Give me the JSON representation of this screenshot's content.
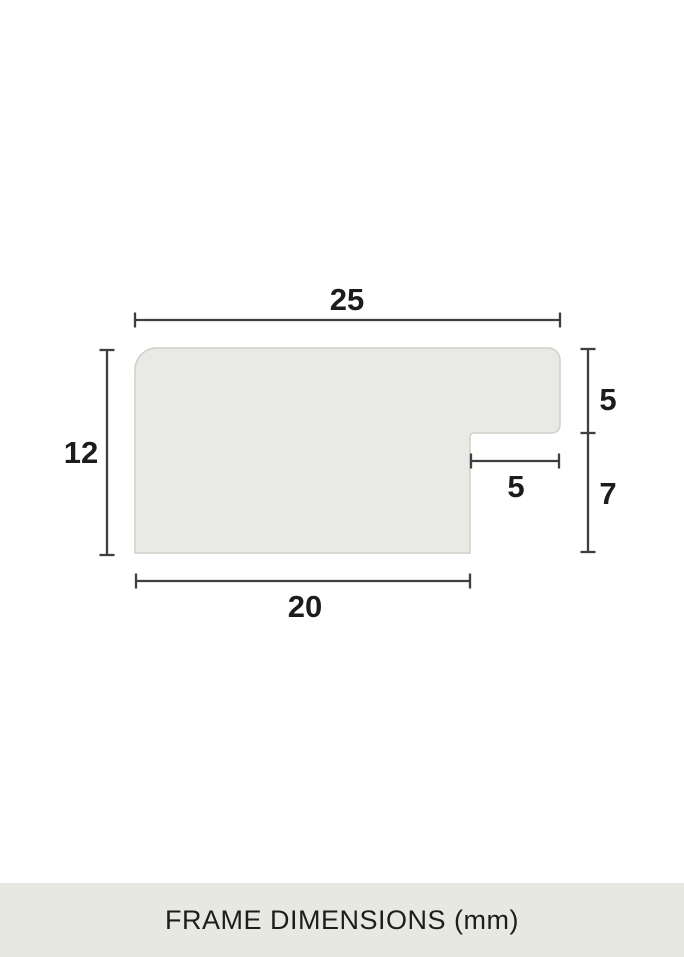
{
  "diagram": {
    "title": "Frame moulding profile cross-section",
    "labels": {
      "top_width": "25",
      "left_height": "12",
      "rabbet_depth": "5",
      "rabbet_width": "5",
      "lower_right_height": "7",
      "bottom_width": "20"
    },
    "caption": "FRAME DIMENSIONS (mm)",
    "unit": "mm",
    "colors": {
      "background": "#ffffff",
      "profile_fill": "#e9e9e5",
      "profile_border": "#cfcfc9",
      "dimension_line": "#3f3f3f",
      "label_text": "#1c1c1c",
      "caption_band": "#e8e8e3",
      "caption_text": "#1d1d1b"
    }
  }
}
